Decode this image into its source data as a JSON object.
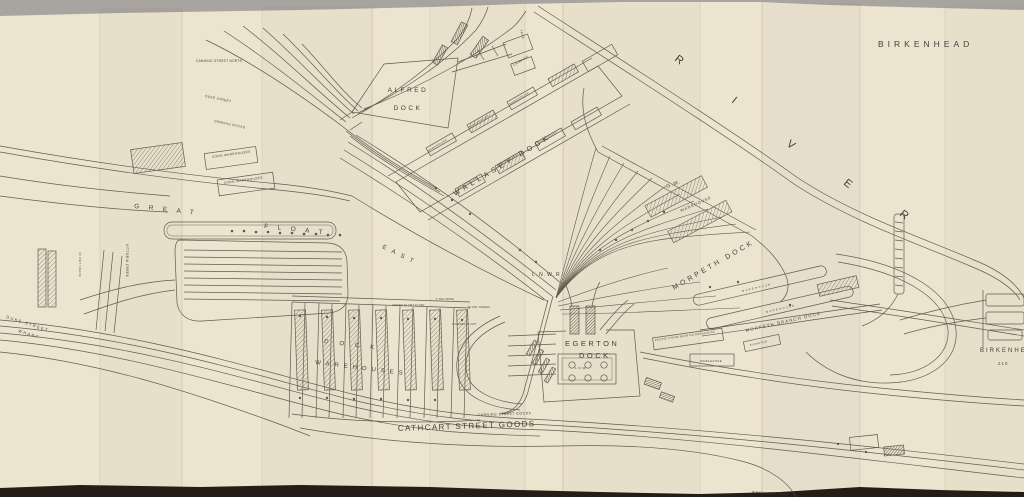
{
  "document": {
    "kind": "scanned-railway-dock-plan",
    "place": "Birkenhead"
  },
  "colors": {
    "bg-top": "#a8a49f",
    "bg-bottom": "#261d16",
    "paper": "#ece4cf",
    "paper-shade": "#e0d7bf",
    "ink": "#50483c",
    "ink-light": "#6f675a",
    "text": "#45413a",
    "crease": "#8a775c"
  },
  "map": {
    "labels": [
      {
        "id": "title",
        "text": "BIRKENHEAD",
        "x": 878,
        "y": 47,
        "size": 8.5,
        "rotate": 0,
        "spacing": 4,
        "anchor": "start"
      },
      {
        "id": "river-r1",
        "text": "R",
        "x": 674,
        "y": 60,
        "size": 11,
        "rotate": 38,
        "spacing": 0,
        "anchor": "start"
      },
      {
        "id": "river-i",
        "text": "I",
        "x": 731,
        "y": 102,
        "size": 11,
        "rotate": 38,
        "spacing": 0,
        "anchor": "start"
      },
      {
        "id": "river-v",
        "text": "V",
        "x": 786,
        "y": 145,
        "size": 11,
        "rotate": 38,
        "spacing": 0,
        "anchor": "start"
      },
      {
        "id": "river-e",
        "text": "E",
        "x": 843,
        "y": 184,
        "size": 11,
        "rotate": 38,
        "spacing": 0,
        "anchor": "start"
      },
      {
        "id": "river-r2",
        "text": "R",
        "x": 899,
        "y": 215,
        "size": 11,
        "rotate": 38,
        "spacing": 0,
        "anchor": "start"
      },
      {
        "id": "alfred-1",
        "text": "ALFRED",
        "x": 408,
        "y": 92,
        "size": 6.5,
        "rotate": 0,
        "spacing": 2.5,
        "anchor": "middle"
      },
      {
        "id": "alfred-2",
        "text": "DOCK",
        "x": 408,
        "y": 110,
        "size": 6.5,
        "rotate": 0,
        "spacing": 2.5,
        "anchor": "middle"
      },
      {
        "id": "wallasey",
        "text": "WALLASEY DOCK",
        "x": 455,
        "y": 196,
        "size": 7.2,
        "rotate": -31,
        "spacing": 4,
        "anchor": "start"
      },
      {
        "id": "great",
        "text": "GREAT",
        "x": 134,
        "y": 208,
        "size": 6.5,
        "rotate": 6,
        "spacing": 9.5,
        "anchor": "start"
      },
      {
        "id": "float",
        "text": "FLOAT",
        "x": 264,
        "y": 228,
        "size": 6.5,
        "rotate": 6,
        "spacing": 9.5,
        "anchor": "start"
      },
      {
        "id": "east",
        "text": "EAST",
        "x": 382,
        "y": 248,
        "size": 6,
        "rotate": 26,
        "spacing": 6,
        "anchor": "start"
      },
      {
        "id": "lnwr",
        "text": "L.N.W.R.",
        "x": 532,
        "y": 276,
        "size": 5,
        "rotate": 0,
        "spacing": 1.5,
        "anchor": "start"
      },
      {
        "id": "egerton-1",
        "text": "EGERTON",
        "x": 565,
        "y": 346,
        "size": 7.5,
        "rotate": 0,
        "spacing": 2.5,
        "anchor": "start"
      },
      {
        "id": "egerton-2",
        "text": "DOCK",
        "x": 579,
        "y": 358,
        "size": 7.5,
        "rotate": 0,
        "spacing": 2.5,
        "anchor": "start"
      },
      {
        "id": "morpeth",
        "text": "MORPETH DOCK",
        "x": 674,
        "y": 290,
        "size": 7,
        "rotate": -30,
        "spacing": 3,
        "anchor": "start"
      },
      {
        "id": "morpeth-branch",
        "text": "MORPETH BRANCH DOCK",
        "x": 746,
        "y": 332,
        "size": 4.3,
        "rotate": -13,
        "spacing": 1.2,
        "anchor": "start"
      },
      {
        "id": "cathcart",
        "text": "CATHCART STREET GOODS",
        "x": 398,
        "y": 431,
        "size": 8,
        "rotate": -2,
        "spacing": 1.4,
        "anchor": "start"
      },
      {
        "id": "canning-goods",
        "text": "CANNING STREET GOODS",
        "x": 478,
        "y": 416,
        "size": 3.4,
        "rotate": -2,
        "spacing": 0.5,
        "anchor": "start"
      },
      {
        "id": "dock-spread",
        "text": "DOCK",
        "x": 324,
        "y": 343,
        "size": 6,
        "rotate": 7,
        "spacing": 11,
        "anchor": "start"
      },
      {
        "id": "warehouses-spread",
        "text": "WAREHOUSES",
        "x": 315,
        "y": 364,
        "size": 6,
        "rotate": 7,
        "spacing": 5,
        "anchor": "start"
      },
      {
        "id": "duke-wharf-1",
        "text": "DUKE STREET",
        "x": 6,
        "y": 318,
        "size": 4,
        "rotate": 18,
        "spacing": 1.5,
        "anchor": "start"
      },
      {
        "id": "duke-wharf-2",
        "text": "WHARF",
        "x": 18,
        "y": 332,
        "size": 4,
        "rotate": 18,
        "spacing": 1.5,
        "anchor": "start"
      },
      {
        "id": "vittoria-creek",
        "text": "VITTORIA CREEK",
        "x": 126,
        "y": 244,
        "size": 3.2,
        "rotate": 90,
        "spacing": 0.5,
        "anchor": "start"
      },
      {
        "id": "crane-left",
        "text": "30 CWT CRANE",
        "x": 79,
        "y": 252,
        "size": 2.6,
        "rotate": 90,
        "spacing": 0.5,
        "anchor": "start"
      },
      {
        "id": "gw",
        "text": "G.W.",
        "x": 667,
        "y": 188,
        "size": 5,
        "rotate": -20,
        "spacing": 1,
        "anchor": "start"
      },
      {
        "id": "gw-warehouse",
        "text": "WAREHOUSE",
        "x": 681,
        "y": 212,
        "size": 3.8,
        "rotate": -24,
        "spacing": 1,
        "anchor": "start"
      },
      {
        "id": "lairage",
        "text": "LAIRAGE",
        "x": 514,
        "y": 66,
        "size": 3.2,
        "rotate": -31,
        "spacing": 0.5,
        "anchor": "start"
      },
      {
        "id": "corn-1",
        "text": "CORN WAREHOUSES",
        "x": 212,
        "y": 158,
        "size": 3.2,
        "rotate": -8,
        "spacing": 0.4,
        "anchor": "start"
      },
      {
        "id": "corn-2",
        "text": "CORN WAREHOUSES",
        "x": 224,
        "y": 184,
        "size": 3.2,
        "rotate": -8,
        "spacing": 0.4,
        "anchor": "start"
      },
      {
        "id": "canning-north",
        "text": "CANNING STREET NORTH",
        "x": 196,
        "y": 62,
        "size": 3.2,
        "rotate": 0,
        "spacing": 0.3,
        "anchor": "start"
      },
      {
        "id": "duke-street",
        "text": "DUKE STREET",
        "x": 205,
        "y": 97,
        "size": 3.2,
        "rotate": 12,
        "spacing": 0.4,
        "anchor": "start"
      },
      {
        "id": "graving-docks",
        "text": "GRAVING DOCKS",
        "x": 214,
        "y": 122,
        "size": 3.2,
        "rotate": 12,
        "spacing": 0.4,
        "anchor": "start"
      },
      {
        "id": "pacific",
        "text": "PACIFIC STEAM NAVN CO WAREHOUSE",
        "x": 655,
        "y": 341,
        "size": 2.7,
        "rotate": -8,
        "spacing": 0.3,
        "anchor": "start"
      },
      {
        "id": "warehouse-1",
        "text": "WAREHOUSE",
        "x": 428,
        "y": 152,
        "size": 2.7,
        "rotate": -31,
        "spacing": 0.6,
        "anchor": "start"
      },
      {
        "id": "warehouse-2",
        "text": "WAREHOUSE",
        "x": 470,
        "y": 128,
        "size": 2.7,
        "rotate": -31,
        "spacing": 0.6,
        "anchor": "start"
      },
      {
        "id": "warehouse-3",
        "text": "WAREHOUSE",
        "x": 510,
        "y": 105,
        "size": 2.7,
        "rotate": -31,
        "spacing": 0.6,
        "anchor": "start"
      },
      {
        "id": "warehouse-4",
        "text": "WAREHOUSE",
        "x": 458,
        "y": 190,
        "size": 2.7,
        "rotate": -31,
        "spacing": 0.6,
        "anchor": "start"
      },
      {
        "id": "warehouse-5",
        "text": "WAREHOUSE",
        "x": 498,
        "y": 167,
        "size": 2.7,
        "rotate": -31,
        "spacing": 0.6,
        "anchor": "start"
      },
      {
        "id": "warehouse-6",
        "text": "WAREHOUSE",
        "x": 538,
        "y": 144,
        "size": 2.7,
        "rotate": -31,
        "spacing": 0.6,
        "anchor": "start"
      },
      {
        "id": "warehouse-box",
        "text": "WAREHOUSE",
        "x": 700,
        "y": 362,
        "size": 2.7,
        "rotate": 0,
        "spacing": 0.5,
        "anchor": "start"
      },
      {
        "id": "elevator",
        "text": "ELEVATOR",
        "x": 750,
        "y": 346,
        "size": 2.7,
        "rotate": -12,
        "spacing": 0.5,
        "anchor": "start"
      },
      {
        "id": "warehouse-pier1",
        "text": "WAREHOUSE",
        "x": 742,
        "y": 292,
        "size": 2.6,
        "rotate": -13,
        "spacing": 1.5,
        "anchor": "start"
      },
      {
        "id": "warehouse-pier2",
        "text": "WAREHOUSE",
        "x": 766,
        "y": 313,
        "size": 2.6,
        "rotate": -13,
        "spacing": 1.5,
        "anchor": "start"
      },
      {
        "id": "birkenhead-cut",
        "text": "BIRKENHEAD",
        "x": 980,
        "y": 352,
        "size": 6,
        "rotate": 0,
        "spacing": 2,
        "anchor": "start"
      },
      {
        "id": "sheet-210",
        "text": "210",
        "x": 998,
        "y": 365,
        "size": 4.5,
        "rotate": 0,
        "spacing": 1,
        "anchor": "start"
      },
      {
        "id": "birkenhead-town",
        "text": "BIRKENHEAD TOWN",
        "x": 752,
        "y": 493,
        "size": 3,
        "rotate": 4,
        "spacing": 0.5,
        "anchor": "start"
      },
      {
        "id": "lnw-shed",
        "text": "L.N.W.",
        "x": 575,
        "y": 369,
        "size": 3,
        "rotate": 0,
        "spacing": 0.5,
        "anchor": "start"
      },
      {
        "id": "cranes-1",
        "text": "CRANES 30 CWT 15 CWT",
        "x": 392,
        "y": 306,
        "size": 2.4,
        "rotate": 0,
        "spacing": 0.2,
        "anchor": "start"
      },
      {
        "id": "cranes-2",
        "text": "6 TON CRANE",
        "x": 436,
        "y": 300,
        "size": 2.4,
        "rotate": 0,
        "spacing": 0.2,
        "anchor": "start"
      },
      {
        "id": "cranes-3",
        "text": "30 CWT CRANES",
        "x": 468,
        "y": 308,
        "size": 2.4,
        "rotate": 0,
        "spacing": 0.2,
        "anchor": "start"
      },
      {
        "id": "cranes-4",
        "text": "4 CRANES 30 CWT",
        "x": 452,
        "y": 325,
        "size": 2.4,
        "rotate": 0,
        "spacing": 0.2,
        "anchor": "start"
      },
      {
        "id": "tank",
        "text": "TANK",
        "x": 520,
        "y": 30,
        "size": 3,
        "rotate": 75,
        "spacing": 0.5,
        "anchor": "start"
      }
    ]
  }
}
